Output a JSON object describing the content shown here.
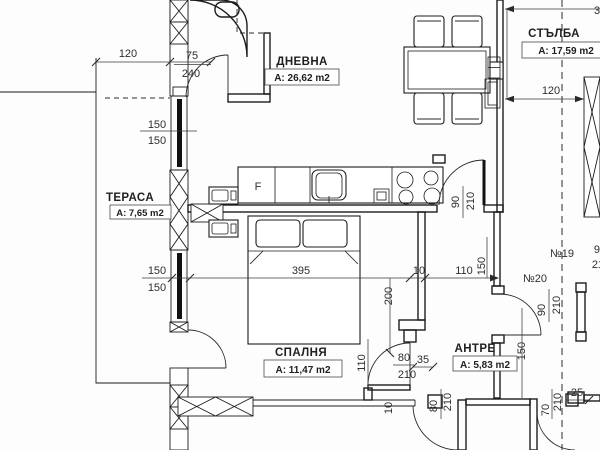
{
  "rooms": {
    "dnevna": {
      "name": "ДНЕВНА",
      "area": "А: 26,62 m2"
    },
    "spalnya": {
      "name": "СПАЛНЯ",
      "area": "А: 11,47 m2"
    },
    "terasa": {
      "name": "ТЕРАСА",
      "area": "А: 7,65 m2"
    },
    "antre": {
      "name": "АНТРЕ",
      "area": "А: 5,83 m2"
    },
    "stalba": {
      "name": "СТЪЛБА",
      "area": "А: 17,59 m2"
    }
  },
  "doors": {
    "n19": {
      "label": "№19",
      "w": "90",
      "h": "210"
    },
    "n20": {
      "label": "№20",
      "w": "90",
      "h": "210"
    }
  },
  "kitchen": {
    "fridge": "F"
  },
  "dims": {
    "terrace_width": "120",
    "entry_door_w": "75",
    "entry_door_h": "240",
    "window1_top": "150",
    "window1_bottom": "150",
    "window2_top": "150",
    "window2_bottom": "150",
    "bedroom_wall": "395",
    "wall_thickness": "10",
    "corridor_width": "110",
    "corridor_height": "150",
    "bed_length": "200",
    "kitchen_door_w": "90",
    "kitchen_door_h": "210",
    "bedroom_door_w": "80",
    "bedroom_door_offset": "35",
    "bedroom_door_h": "210",
    "bedroom_door_side": "110",
    "antre_width": "150",
    "sill": "10",
    "exit_door1_w": "80",
    "exit_door1_h": "210",
    "exit_door2_w": "70",
    "exit_door2_h": "210",
    "offset_25": "25",
    "stairs_width": "120",
    "top_partial": "3"
  }
}
